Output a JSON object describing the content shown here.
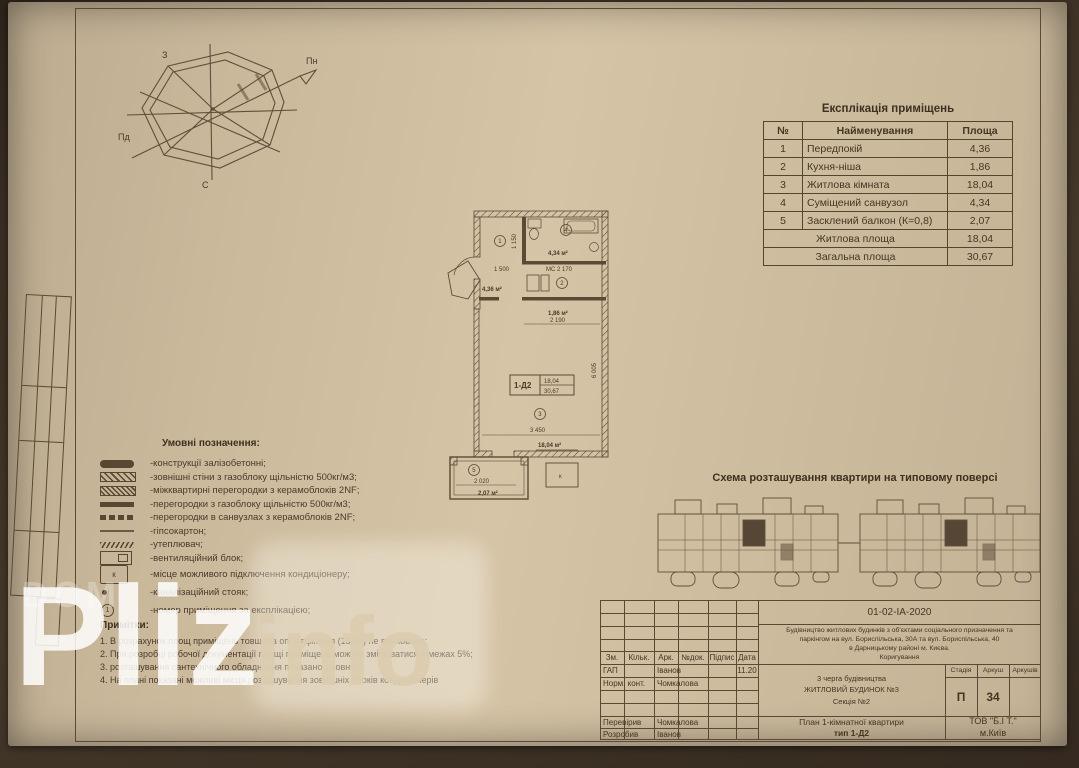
{
  "compass": {
    "n": "Пн",
    "w": "З",
    "s": "Пд",
    "e": "С"
  },
  "explication": {
    "title": "Експлікація приміщень",
    "headers": {
      "num": "№",
      "name": "Найменування",
      "area": "Площа"
    },
    "rows": [
      {
        "num": "1",
        "name": "Передпокій",
        "area": "4,36"
      },
      {
        "num": "2",
        "name": "Кухня-ніша",
        "area": "1,86"
      },
      {
        "num": "3",
        "name": "Житлова кімната",
        "area": "18,04"
      },
      {
        "num": "4",
        "name": "Суміщений санвузол",
        "area": "4,34"
      },
      {
        "num": "5",
        "name": "Засклений балкон (К=0,8)",
        "area": "2,07"
      }
    ],
    "summary": [
      {
        "name": "Житлова площа",
        "area": "18,04"
      },
      {
        "name": "Загальна площа",
        "area": "30,67"
      }
    ]
  },
  "plan": {
    "tag": "1-Д2",
    "tag_area_living": "18,04",
    "tag_area_total": "30,67",
    "room1": "1",
    "room2": "2",
    "room3": "3",
    "room4": "4",
    "room5": "5",
    "area1": "4,36 м²",
    "area2": "1,86 м²",
    "area3": "18,04 м²",
    "area4": "4,34 м²",
    "area5": "2,07 м²",
    "dim_1500": "1 500",
    "dim_ms": "МС 2 170",
    "dim_2190": "2 190",
    "dim_3450": "3 450",
    "dim_2020": "2 020",
    "dim_6005": "6 005",
    "dim_1150": "1 150",
    "k": "к"
  },
  "legend": {
    "title": "Умовні позначення:",
    "k_symbol": "к",
    "circle_num": "1",
    "items": [
      {
        "label": "-конструкції залізобетонні;"
      },
      {
        "label": "-зовнішні стіни з газоблоку щільністю 500кг/м3;"
      },
      {
        "label": "-міжквартирні перегородки з керамоблоків 2NF;"
      },
      {
        "label": "-перегородки з газоблоку щільністю 500кг/м3;"
      },
      {
        "label": "-перегородки в санвузлах з керамоблоків 2NF;"
      },
      {
        "label": "-гіпсокартон;"
      },
      {
        "label": "-утеплювач;"
      },
      {
        "label": "-вентиляційний блок;"
      },
      {
        "label": "-місце можливого підключення кондиціонеру;"
      },
      {
        "label": "-каналізаційний стояк;"
      },
      {
        "label": "-номер приміщення за експлікацією;"
      }
    ]
  },
  "notes": {
    "title": "Примітки:",
    "items": [
      "1. В розрахунок площ приміщень товщина опорядження (15мм) не врахована;",
      "2. При розробці робочої документації площі приміщень можуть змінюватися в межах 5%;",
      "3. розташування сантехнічного обладнання показано умовно;",
      "4. На плані показані можливі місця розташування зовнішніх блоків кондиціонерів"
    ]
  },
  "scheme": {
    "title": "Схема розташування квартири на типовому поверсі"
  },
  "titleblock": {
    "doc_number": "01-02-ІА-2020",
    "project_l1": "Будівництво житлових будинків з об'єктами соціального призначення та",
    "project_l2": "паркінгом на вул. Бориспільська, 30А та вул. Бориспільська, 40",
    "project_l3": "в Дарницькому районі м. Києва.",
    "project_l4": "Коригування",
    "cols": {
      "zm": "Зм.",
      "kilk": "Кільк.",
      "ark": "Арк.",
      "ndok": "№док.",
      "pidpys": "Підпис",
      "data": "Дата"
    },
    "rows": [
      {
        "role": "ГАП",
        "name": "Іванов",
        "date": "11.20"
      },
      {
        "role": "Норм. конт.",
        "name": "Чомкалова",
        "date": ""
      },
      {
        "role": "Перевірив",
        "name": "Чомкалова",
        "date": ""
      },
      {
        "role": "Розробив",
        "name": "Іванов",
        "date": ""
      }
    ],
    "object_line1": "3 черга будівництва",
    "object_line2": "ЖИТЛОВИЙ БУДИНОК №3",
    "object_line3": "Секція №2",
    "stage_label": "Стадія",
    "sheet_label": "Аркуш",
    "sheets_label": "Аркушів",
    "stage": "П",
    "sheet_no": "34",
    "title_line1": "План 1-кімнатної квартири",
    "title_line2": "тип 1-Д2",
    "company_line1": "ТОВ \"Б.І Т.\"",
    "company_line2": "м.Київ"
  },
  "watermark": {
    "dom": "DOM",
    "pliz": "Pliz",
    "info": "info"
  }
}
